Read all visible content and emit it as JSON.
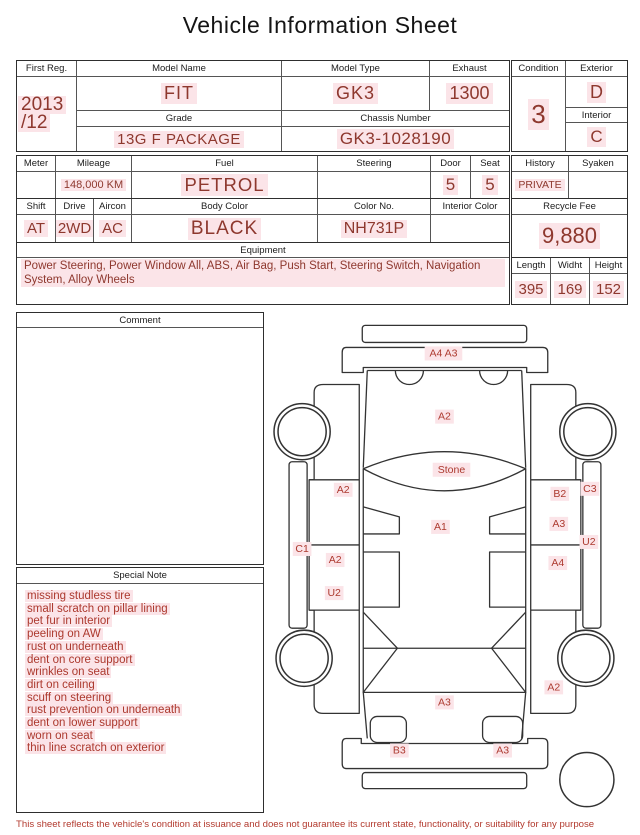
{
  "page": {
    "title": "Vehicle Information Sheet",
    "footer": "This sheet reflects the vehicle's condition at issuance and does not guarantee its current state, functionality, or suitability for any purpose"
  },
  "registration": {
    "first_reg_label": "First Reg.",
    "first_reg_year": "2013",
    "first_reg_month": "/12",
    "model_name_label": "Model Name",
    "model_name": "FIT",
    "model_type_label": "Model Type",
    "model_type": "GK3",
    "exhaust_label": "Exhaust",
    "exhaust": "1300",
    "grade_label": "Grade",
    "grade": "13G F PACKAGE",
    "chassis_label": "Chassis Number",
    "chassis": "GK3-1028190"
  },
  "condition": {
    "condition_label": "Condition",
    "condition": "3",
    "exterior_label": "Exterior",
    "exterior": "D",
    "interior_label": "Interior",
    "interior": "C"
  },
  "spec": {
    "meter_label": "Meter",
    "meter": "",
    "mileage_label": "Mileage",
    "mileage": "148,000 KM",
    "fuel_label": "Fuel",
    "fuel": "PETROL",
    "steering_label": "Steering",
    "steering": "",
    "door_label": "Door",
    "door": "5",
    "seat_label": "Seat",
    "seat": "5",
    "shift_label": "Shift",
    "shift": "AT",
    "drive_label": "Drive",
    "drive": "2WD",
    "aircon_label": "Aircon",
    "aircon": "AC",
    "body_color_label": "Body Color",
    "body_color": "BLACK",
    "color_no_label": "Color No.",
    "color_no": "NH731P",
    "interior_color_label": "Interior Color",
    "interior_color": ""
  },
  "history": {
    "history_label": "History",
    "history": "PRIVATE",
    "syaken_label": "Syaken",
    "syaken": ""
  },
  "recycle": {
    "label": "Recycle Fee",
    "fee": "9,880"
  },
  "dimensions": {
    "length_label": "Length",
    "length": "395",
    "width_label": "Widht",
    "width": "169",
    "height_label": "Height",
    "height": "152"
  },
  "equipment": {
    "label": "Equipment",
    "items": "Power Steering, Power Window  All, ABS, Air Bag, Push Start, Steering Switch, Navigation System, Alloy Wheels"
  },
  "comment": {
    "label": "Comment",
    "text": ""
  },
  "special_note": {
    "label": "Special Note",
    "items": [
      "missing studless tire",
      "small scratch on pillar lining",
      "pet fur in interior",
      "peeling on AW",
      "rust on underneath",
      "dent on core support",
      "wrinkles on seat",
      "dirt on ceiling",
      "scuff on steering",
      "rust prevention on underneath",
      "dent on lower support",
      "worn on seat",
      "thin line scratch on exterior"
    ]
  },
  "diagram": {
    "labels": [
      {
        "text": "A4 A3",
        "x": 179,
        "y": 49
      },
      {
        "text": "A2",
        "x": 180,
        "y": 112
      },
      {
        "text": "Stone",
        "x": 187,
        "y": 165
      },
      {
        "text": "A2",
        "x": 79,
        "y": 185
      },
      {
        "text": "B2",
        "x": 295,
        "y": 189
      },
      {
        "text": "C3",
        "x": 325,
        "y": 184
      },
      {
        "text": "A1",
        "x": 176,
        "y": 222
      },
      {
        "text": "A3",
        "x": 294,
        "y": 219
      },
      {
        "text": "C1",
        "x": 38,
        "y": 244
      },
      {
        "text": "U2",
        "x": 324,
        "y": 237
      },
      {
        "text": "A2",
        "x": 71,
        "y": 255
      },
      {
        "text": "A4",
        "x": 293,
        "y": 258
      },
      {
        "text": "U2",
        "x": 70,
        "y": 288
      },
      {
        "text": "A2",
        "x": 289,
        "y": 382
      },
      {
        "text": "A3",
        "x": 180,
        "y": 397
      },
      {
        "text": "B3",
        "x": 135,
        "y": 445
      },
      {
        "text": "A3",
        "x": 238,
        "y": 445
      }
    ]
  },
  "colors": {
    "value_red": "#8e382e",
    "note_red": "#ac392e",
    "highlight_pink": "#fbe4e8",
    "border_dark": "#2e2e2e",
    "line_dark": "#333333"
  }
}
